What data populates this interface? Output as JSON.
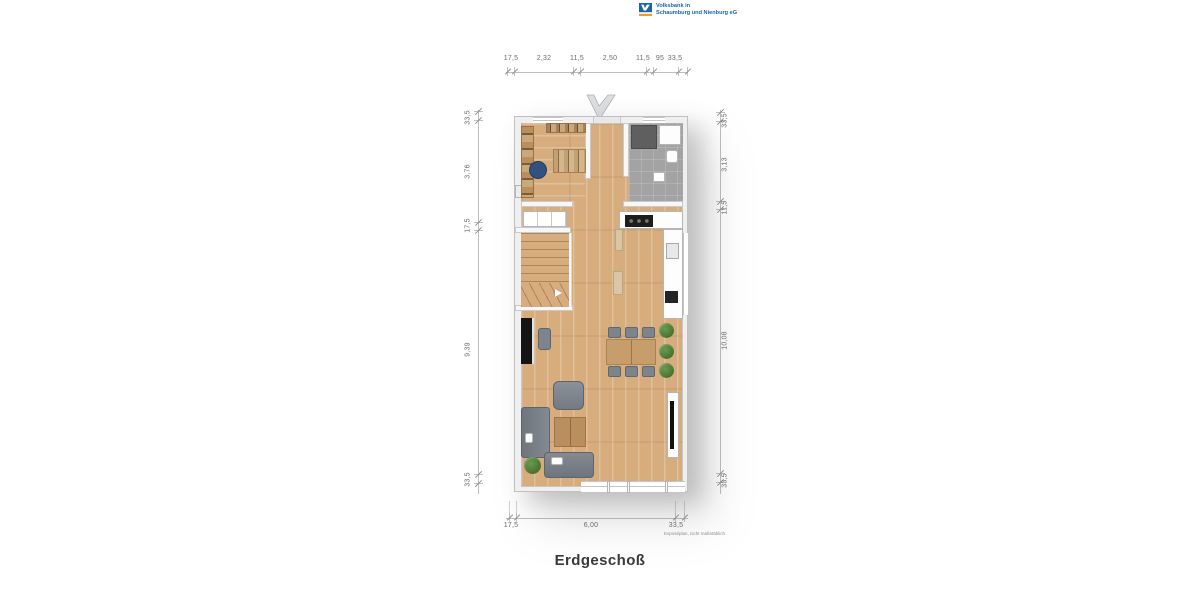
{
  "logo": {
    "line1": "Volksbank in",
    "line2": "Schaumburg und Nienburg eG"
  },
  "title": "Erdgeschoß",
  "footnote": "Exposéplan, nicht maßstäblich",
  "dimensions": {
    "top": [
      "17,5",
      "2,32",
      "11,5",
      "2,50",
      "11,5",
      "95",
      "33,5"
    ],
    "left": [
      "33,5",
      "3,76",
      "17,5",
      "9,39",
      "33,5"
    ],
    "right": [
      "33,5",
      "3,13",
      "11,5",
      "10,08",
      "33,5"
    ],
    "bottom": [
      "17,5",
      "6,00",
      "33,5"
    ]
  },
  "colors": {
    "brand-blue": "#1a64ad",
    "brand-orange": "#f29b1d",
    "wood": "#d7ad7e",
    "table-wood": "#c79d6b",
    "tile": "#a3a3a3",
    "furniture": "#7e848b",
    "plant": "#46702f",
    "text-dim": "#6b6b6b",
    "title-color": "#3a3a3a"
  }
}
